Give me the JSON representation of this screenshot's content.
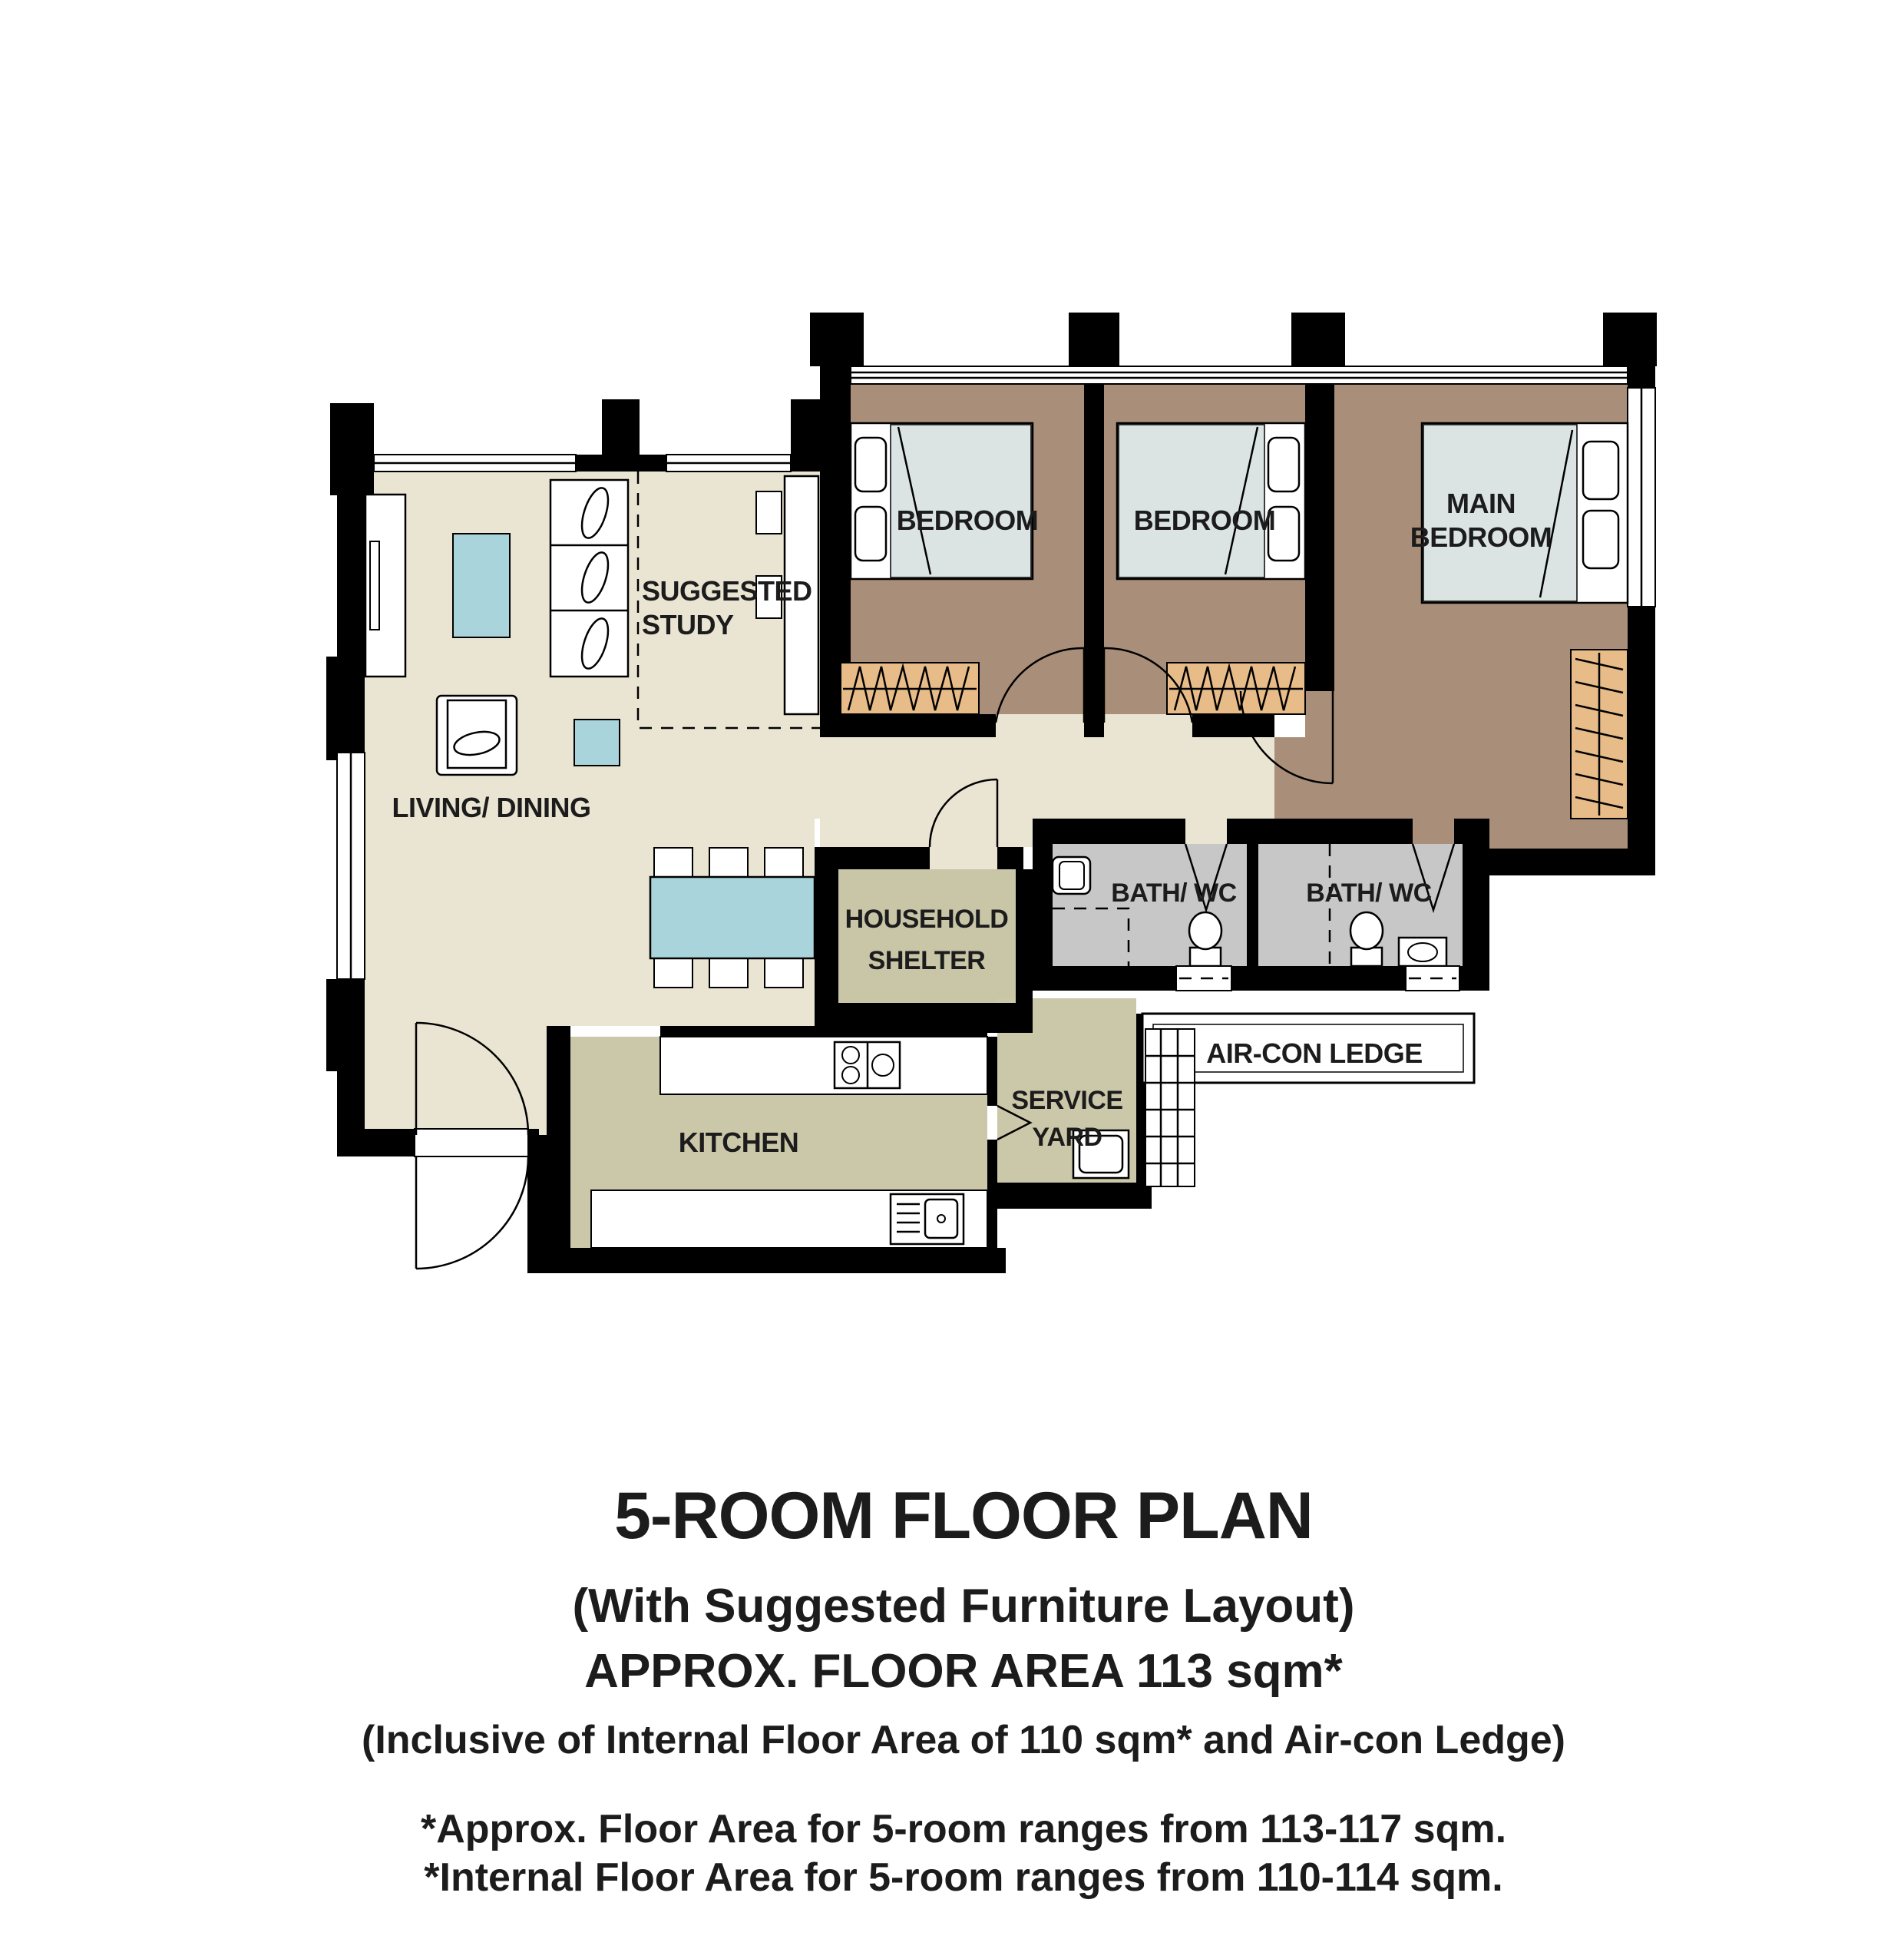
{
  "title_block": {
    "title": "5-ROOM FLOOR PLAN",
    "subtitle": "(With Suggested Furniture Layout)",
    "area_line": "APPROX. FLOOR AREA 113 sqm*",
    "inclusive_line": "(Inclusive of Internal Floor Area of 110 sqm* and Air-con Ledge)",
    "footnote1": "*Approx. Floor Area for 5-room ranges from 113-117 sqm.",
    "footnote2": "*Internal Floor Area for 5-room ranges from 110-114 sqm."
  },
  "rooms": {
    "bedroom1": {
      "label": "BEDROOM"
    },
    "bedroom2": {
      "label": "BEDROOM"
    },
    "main_bedroom": {
      "label_line1": "MAIN",
      "label_line2": "BEDROOM"
    },
    "living_dining": {
      "label": "LIVING/ DINING"
    },
    "suggested_study": {
      "label_line1": "SUGGESTED",
      "label_line2": "STUDY"
    },
    "household_shelter": {
      "label_line1": "HOUSEHOLD",
      "label_line2": "SHELTER"
    },
    "bath1": {
      "label": "BATH/ WC"
    },
    "bath2": {
      "label": "BATH/ WC"
    },
    "kitchen": {
      "label": "KITCHEN"
    },
    "service_yard": {
      "label_line1": "SERVICE",
      "label_line2": "YARD"
    },
    "aircon_ledge": {
      "label": "AIR-CON LEDGE"
    }
  },
  "colors": {
    "wall": "#000000",
    "living_floor": "#eae5d3",
    "bedroom_floor": "#a98f79",
    "kitchen_floor": "#cbc7a9",
    "shelter_floor": "#c9c5a7",
    "bath_floor": "#c7c7c7",
    "table_blue": "#a9d4dc",
    "bed_blue": "#dbe4e3",
    "wardrobe_tan": "#e7bc89",
    "window_white": "#ffffff"
  }
}
